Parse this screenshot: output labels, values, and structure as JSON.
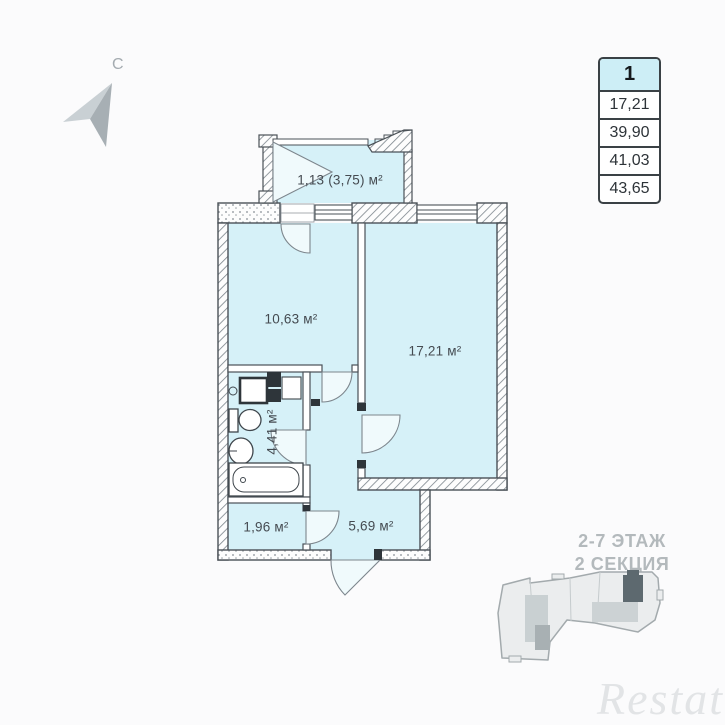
{
  "compass": {
    "north_label": "С"
  },
  "info_table": {
    "apartment_number": "1",
    "rows": [
      "17,21",
      "39,90",
      "41,03",
      "43,65"
    ]
  },
  "plan": {
    "rooms": [
      {
        "name": "loggia",
        "label": "1,13 (3,75) м²"
      },
      {
        "name": "kitchen",
        "label": "10,63 м²"
      },
      {
        "name": "living-room",
        "label": "17,21 м²"
      },
      {
        "name": "bathroom",
        "label": "4,41 м²"
      },
      {
        "name": "storage",
        "label": "1,96 м²"
      },
      {
        "name": "hallway",
        "label": "5,69 м²"
      }
    ],
    "room_fill_color": "#d6f1f8",
    "wall_color": "#4a5157"
  },
  "location": {
    "floors": "2-7 ЭТАЖ",
    "section": "2 СЕКЦИЯ",
    "highlight_color": "#5d696f"
  },
  "watermark": {
    "text": "Restate"
  }
}
